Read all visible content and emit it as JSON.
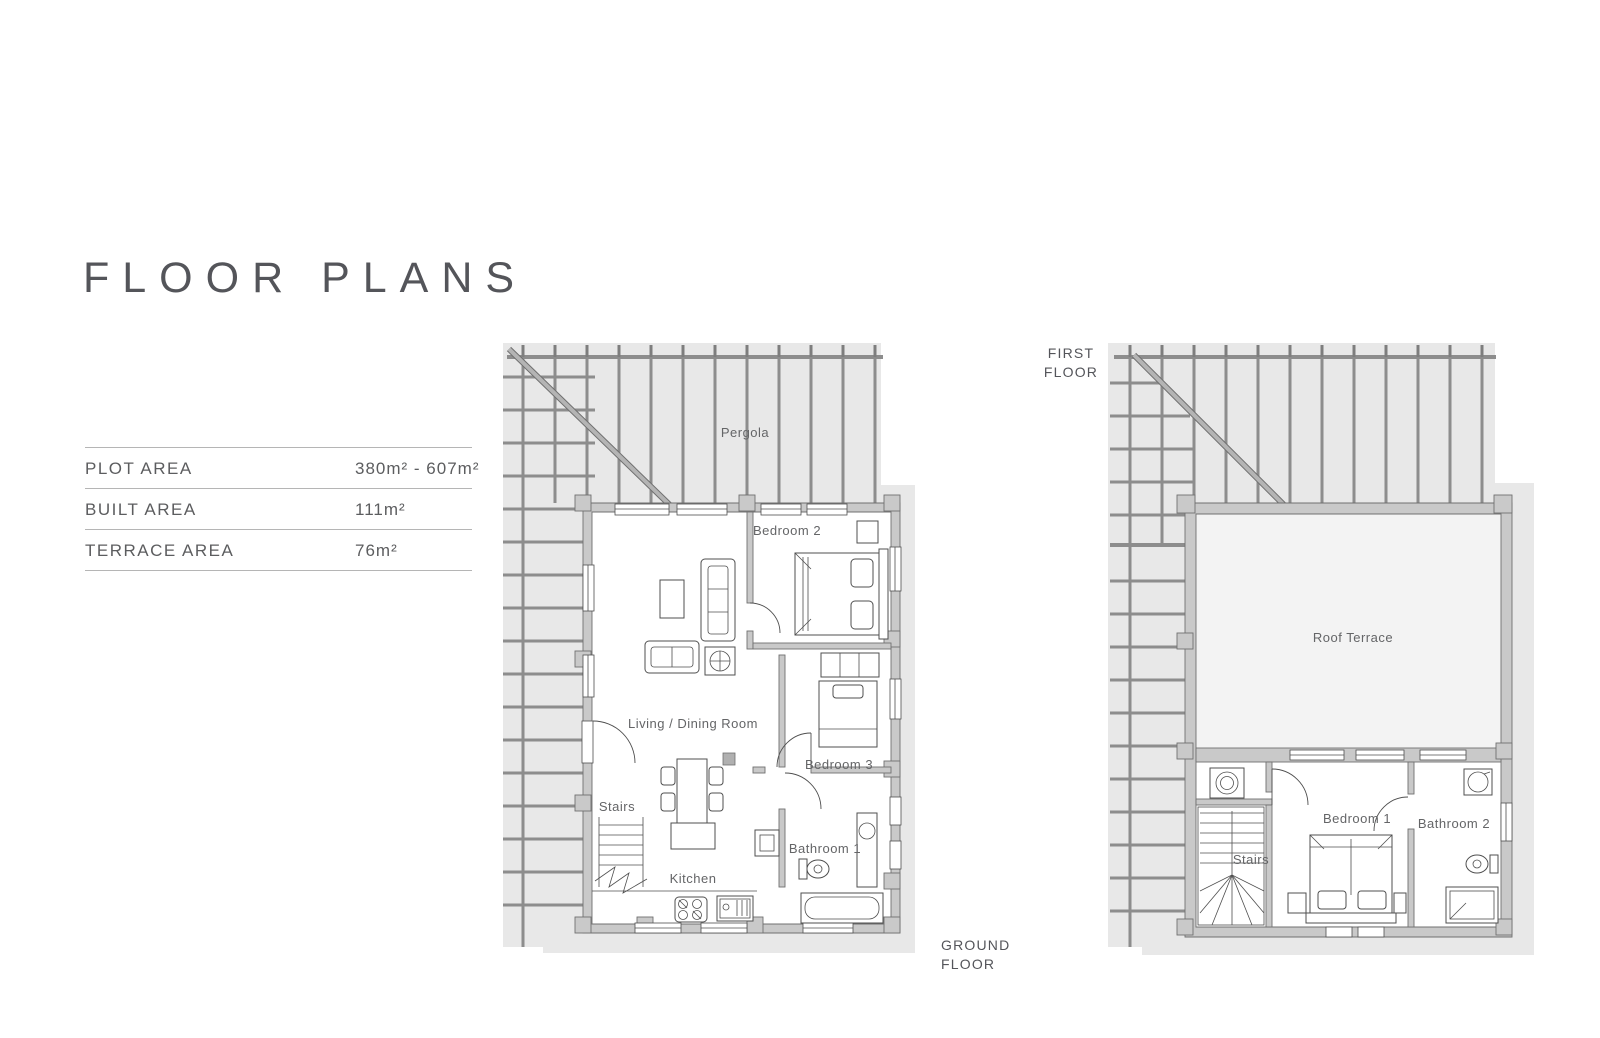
{
  "page": {
    "title": "FLOOR PLANS"
  },
  "area_table": {
    "rows": [
      {
        "label": "PLOT AREA",
        "value": "380m² - 607m²"
      },
      {
        "label": "BUILT AREA",
        "value": "111m²"
      },
      {
        "label": "TERRACE AREA",
        "value": "76m²"
      }
    ]
  },
  "ground_floor": {
    "caption": "GROUND FLOOR",
    "rooms": {
      "pergola": "Pergola",
      "bedroom2": "Bedroom 2",
      "living_dining": "Living / Dining Room",
      "bedroom3": "Bedroom 3",
      "stairs": "Stairs",
      "bathroom1": "Bathroom 1",
      "kitchen": "Kitchen"
    }
  },
  "first_floor": {
    "caption": "FIRST FLOOR",
    "rooms": {
      "roof_terrace": "Roof Terrace",
      "bedroom1": "Bedroom 1",
      "bathroom2": "Bathroom 2",
      "stairs": "Stairs"
    }
  },
  "colors": {
    "heading_text": "#54555a",
    "label_text": "#646567",
    "pergola_background": "#e8e8e8",
    "wall_fill": "#c9c9c9",
    "wall_outline": "#707070",
    "beam": "#8d8d8d",
    "terrace_fill": "#f3f3f3",
    "furniture_outline": "#4f4f4f",
    "table_line": "#b5b5b5"
  }
}
